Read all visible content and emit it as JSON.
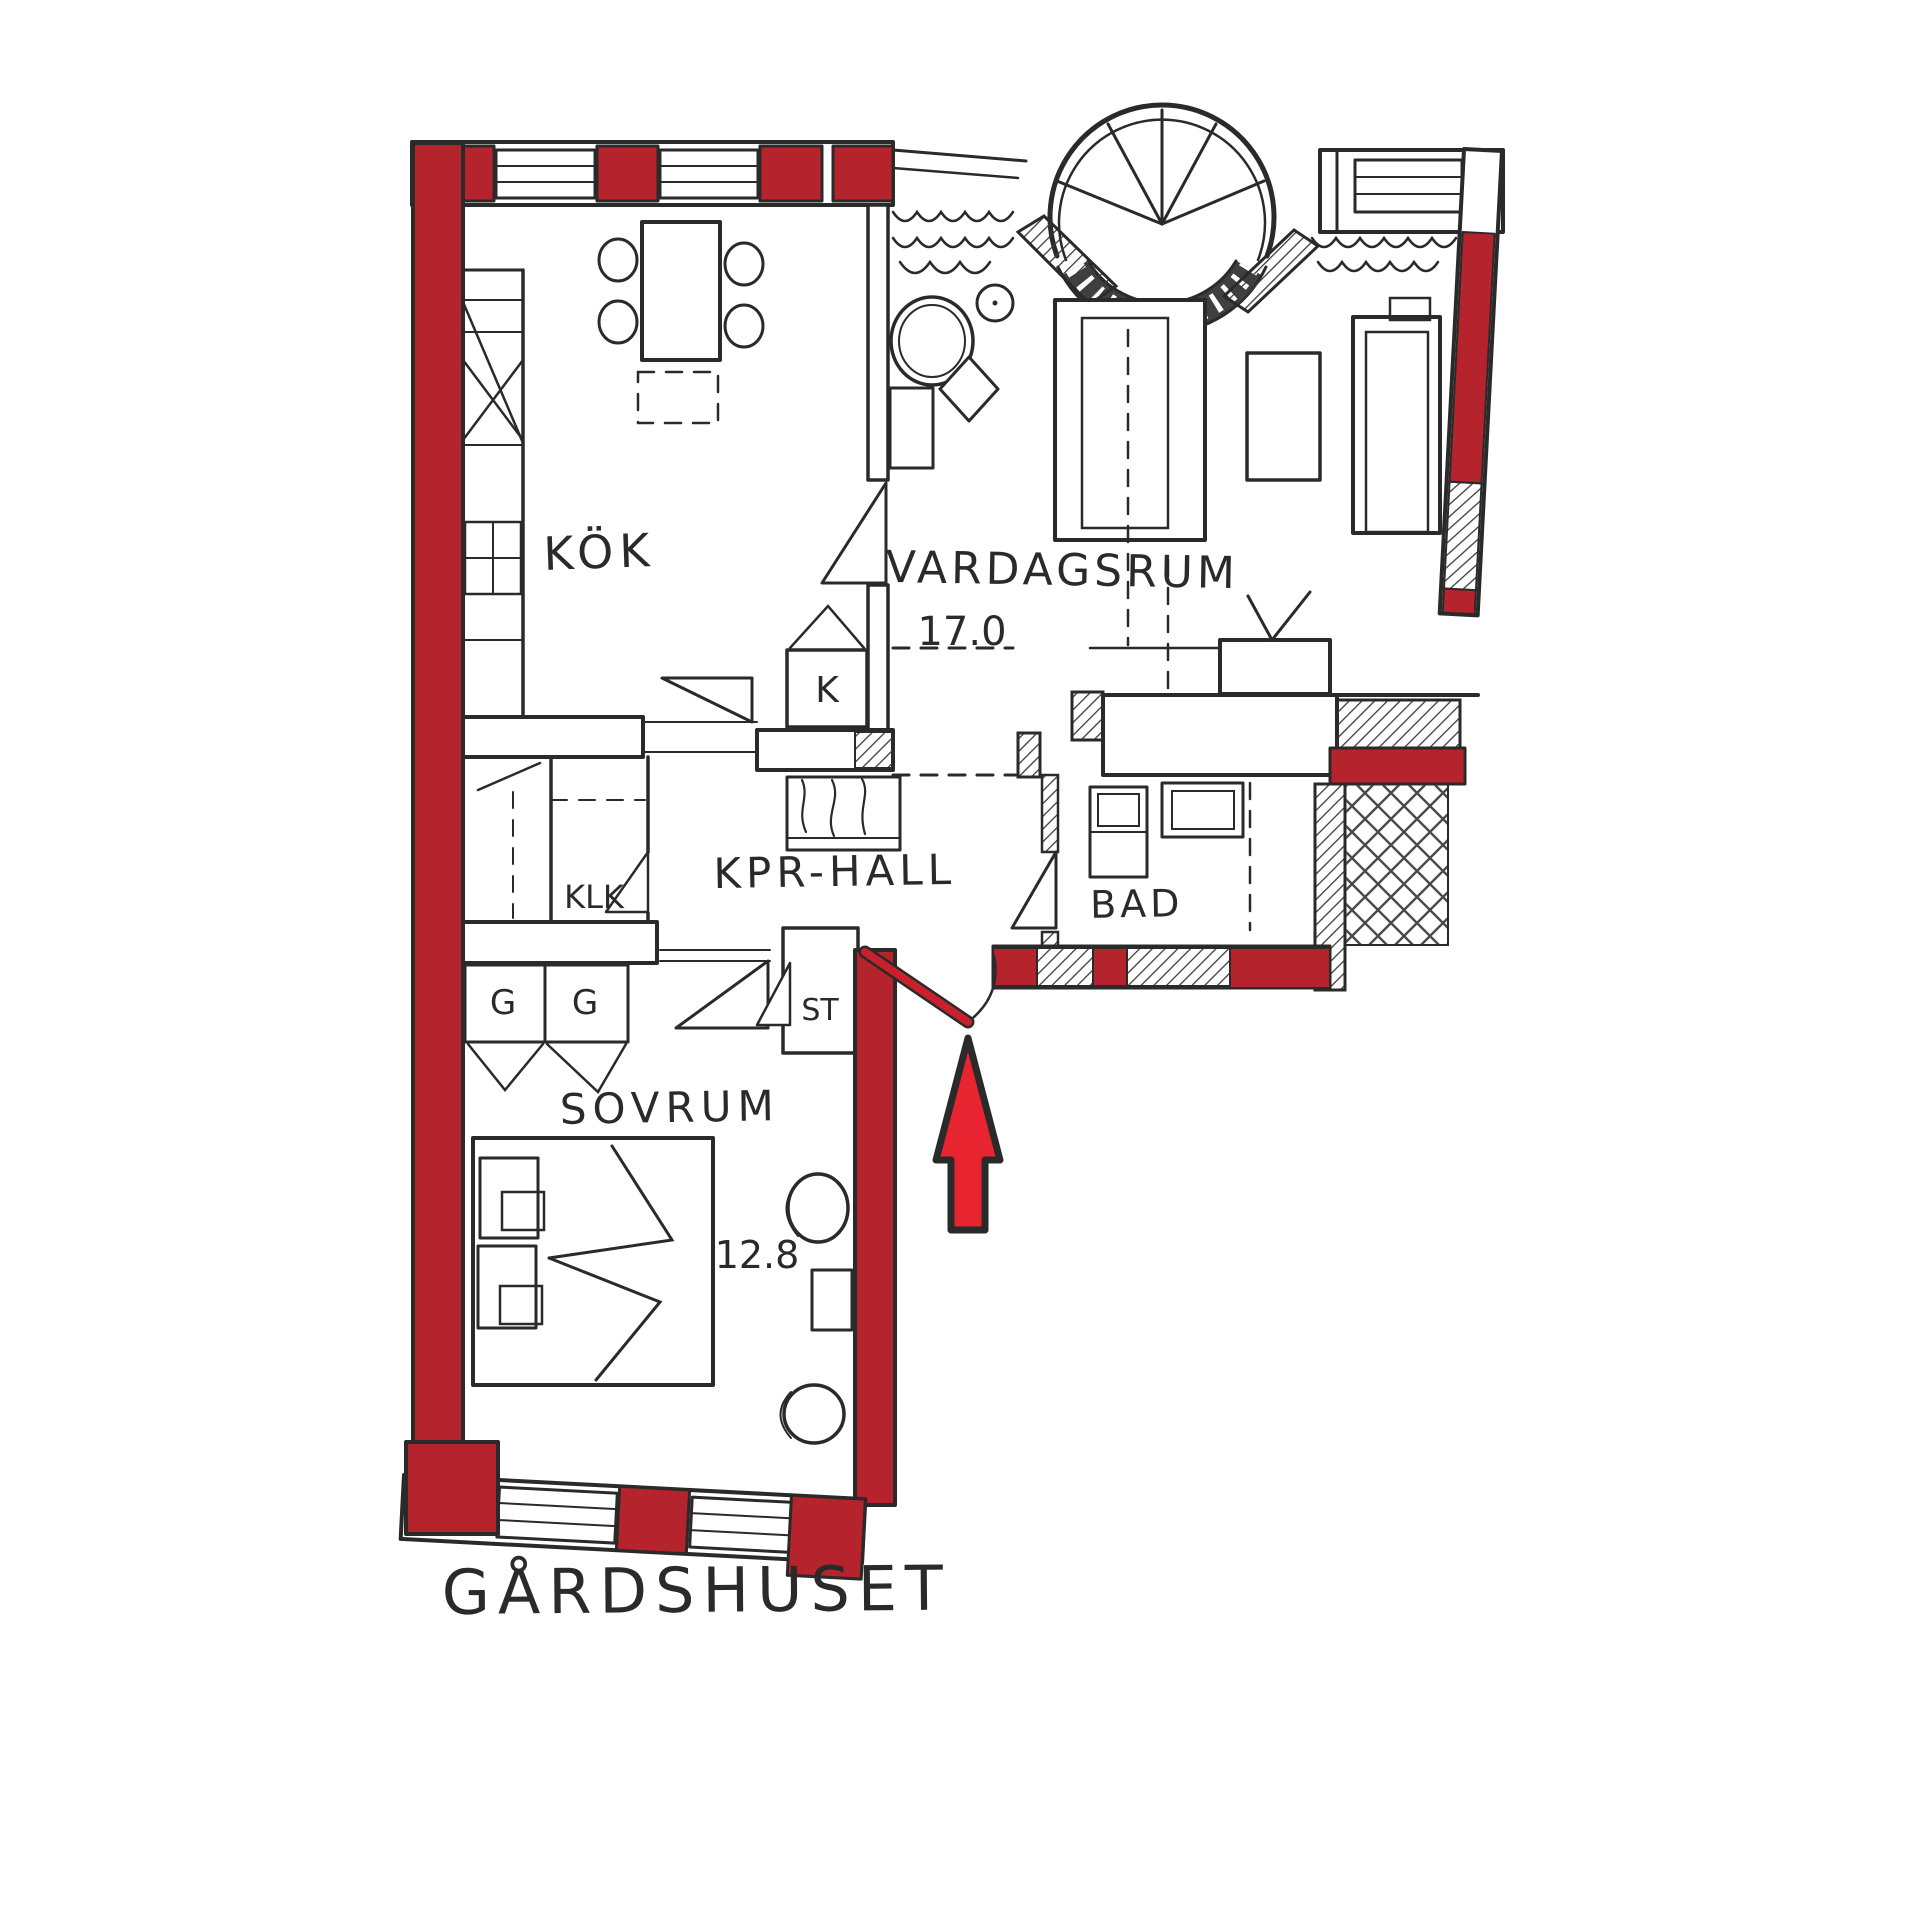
{
  "page": {
    "caption": "GÅRDSHUSET"
  },
  "colors": {
    "wall_red": "#b5232c",
    "door_red": "#c8202d",
    "arrow_red": "#e82430",
    "ink": "#2a2a2a",
    "sill_dark": "#3f3f3f"
  },
  "rooms": {
    "kitchen": {
      "label": "KÖK"
    },
    "living_room": {
      "label": "VARDAGSRUM",
      "area": "17.0"
    },
    "hall": {
      "label": "KPR-HALL"
    },
    "bathroom": {
      "label": "BAD"
    },
    "bedroom": {
      "label": "SOVRUM",
      "area": "12.8"
    },
    "walk_in_closet": {
      "label": "KLK"
    },
    "cleaning_closet": {
      "label": "ST"
    },
    "wardrobe_1": {
      "label": "G"
    },
    "wardrobe_2": {
      "label": "G"
    },
    "fridge": {
      "label": "K"
    }
  }
}
